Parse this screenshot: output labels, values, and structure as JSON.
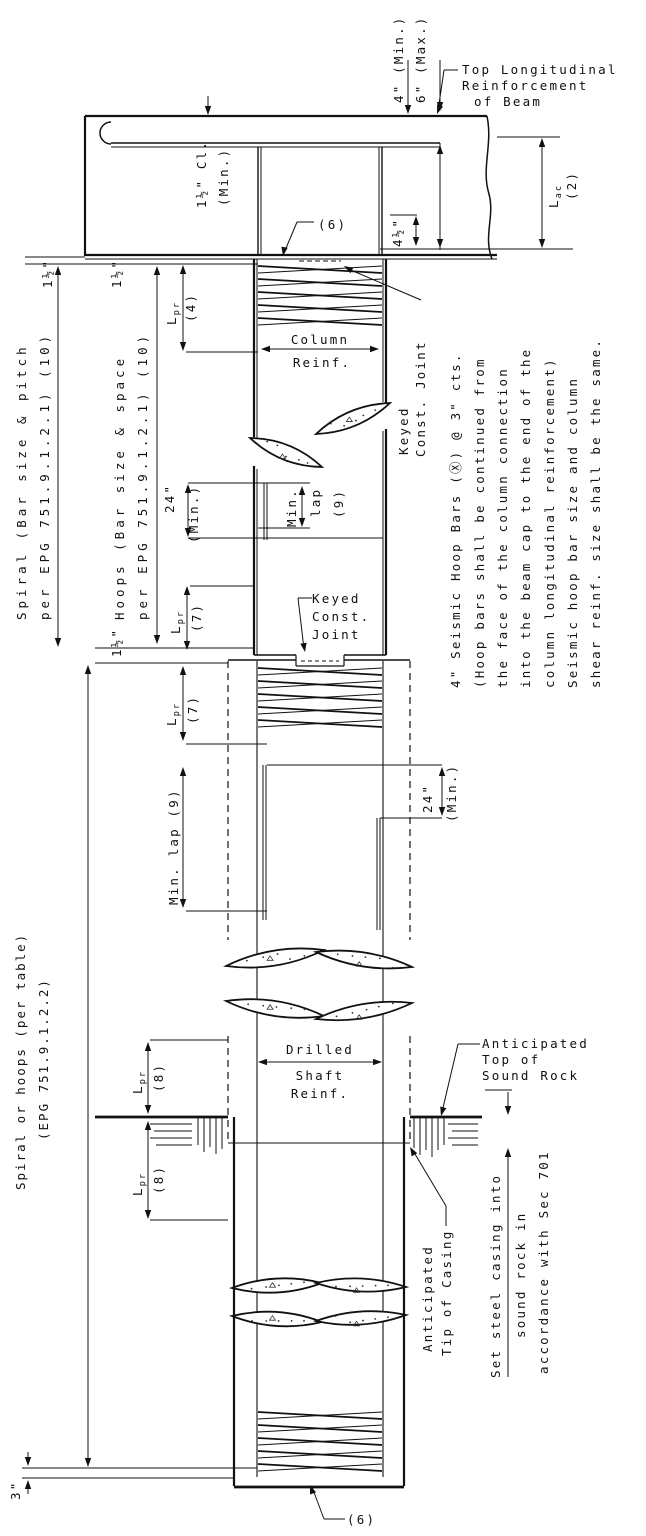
{
  "beam": {
    "top_reinforcement_label": [
      "Top Longitudinal",
      "Reinforcement",
      "of Beam"
    ],
    "hook_clearance_min": "4\" (Min.)",
    "hook_clearance_max": "6\" (Max.)",
    "cover": "1½\" Cl.",
    "cover_qual": "(Min.)",
    "anchorage_sym": "L{ac}",
    "anchorage_ref": "(2)",
    "hook_ext": "4½\"",
    "spiral_callout": "(6)"
  },
  "column": {
    "reinf_label": [
      "Column",
      "Reinf."
    ],
    "spiral_note": [
      "Spiral (Bar size & pitch",
      "per EPG 751.9.1.2.1) (10)"
    ],
    "hoops_note": [
      "Hoops (Bar size & space",
      "per EPG 751.9.1.2.1) (10)"
    ],
    "gap_top_spiral": "1½\"",
    "gap_top_hoops": "1½\"",
    "gap_joint": "1½\"",
    "lap_24": "24\"",
    "lap_24_qual": "(Min.)",
    "min_lap": [
      "Min.",
      "lap",
      "(9)"
    ],
    "lpr_sym": "L{pr}",
    "lpr4_ref": "(4)",
    "lpr7_ref": "(7)"
  },
  "joints": {
    "keyed_vertical": [
      "Keyed",
      "Const. Joint"
    ],
    "keyed_horizontal": [
      "Keyed",
      "Const.",
      "Joint"
    ]
  },
  "shaft": {
    "reinf_label": [
      "Drilled",
      "Shaft",
      "Reinf."
    ],
    "spiral_note": [
      "Spiral or hoops (per table)",
      "(EPG 751.9.1.2.2)"
    ],
    "min_lap": "Min. lap (9)",
    "lap_24": "24\"",
    "lap_24_qual": "(Min.)",
    "lpr7_ref": "(7)",
    "lpr8_ref": "(8)",
    "bottom_gap": "3\"",
    "spiral_callout": "(6)"
  },
  "rock": {
    "top_label": [
      "Anticipated",
      "Top of",
      "Sound Rock"
    ],
    "tip_label": [
      "Anticipated",
      "Tip of Casing"
    ],
    "casing_note": [
      "Set steel casing into",
      "sound rock in",
      "accordance with Sec 701"
    ]
  },
  "notes": {
    "seismic": [
      "4\" Seismic Hoop Bars (Ⓧ) @ 3\" cts.",
      "(Hoop bars shall be continued from",
      "the face of the column connection",
      "into the beam cap to the end of the",
      "column longitudinal reinforcement)",
      "Seismic hoop bar size and column",
      "shear reinf. size shall be the same."
    ]
  }
}
